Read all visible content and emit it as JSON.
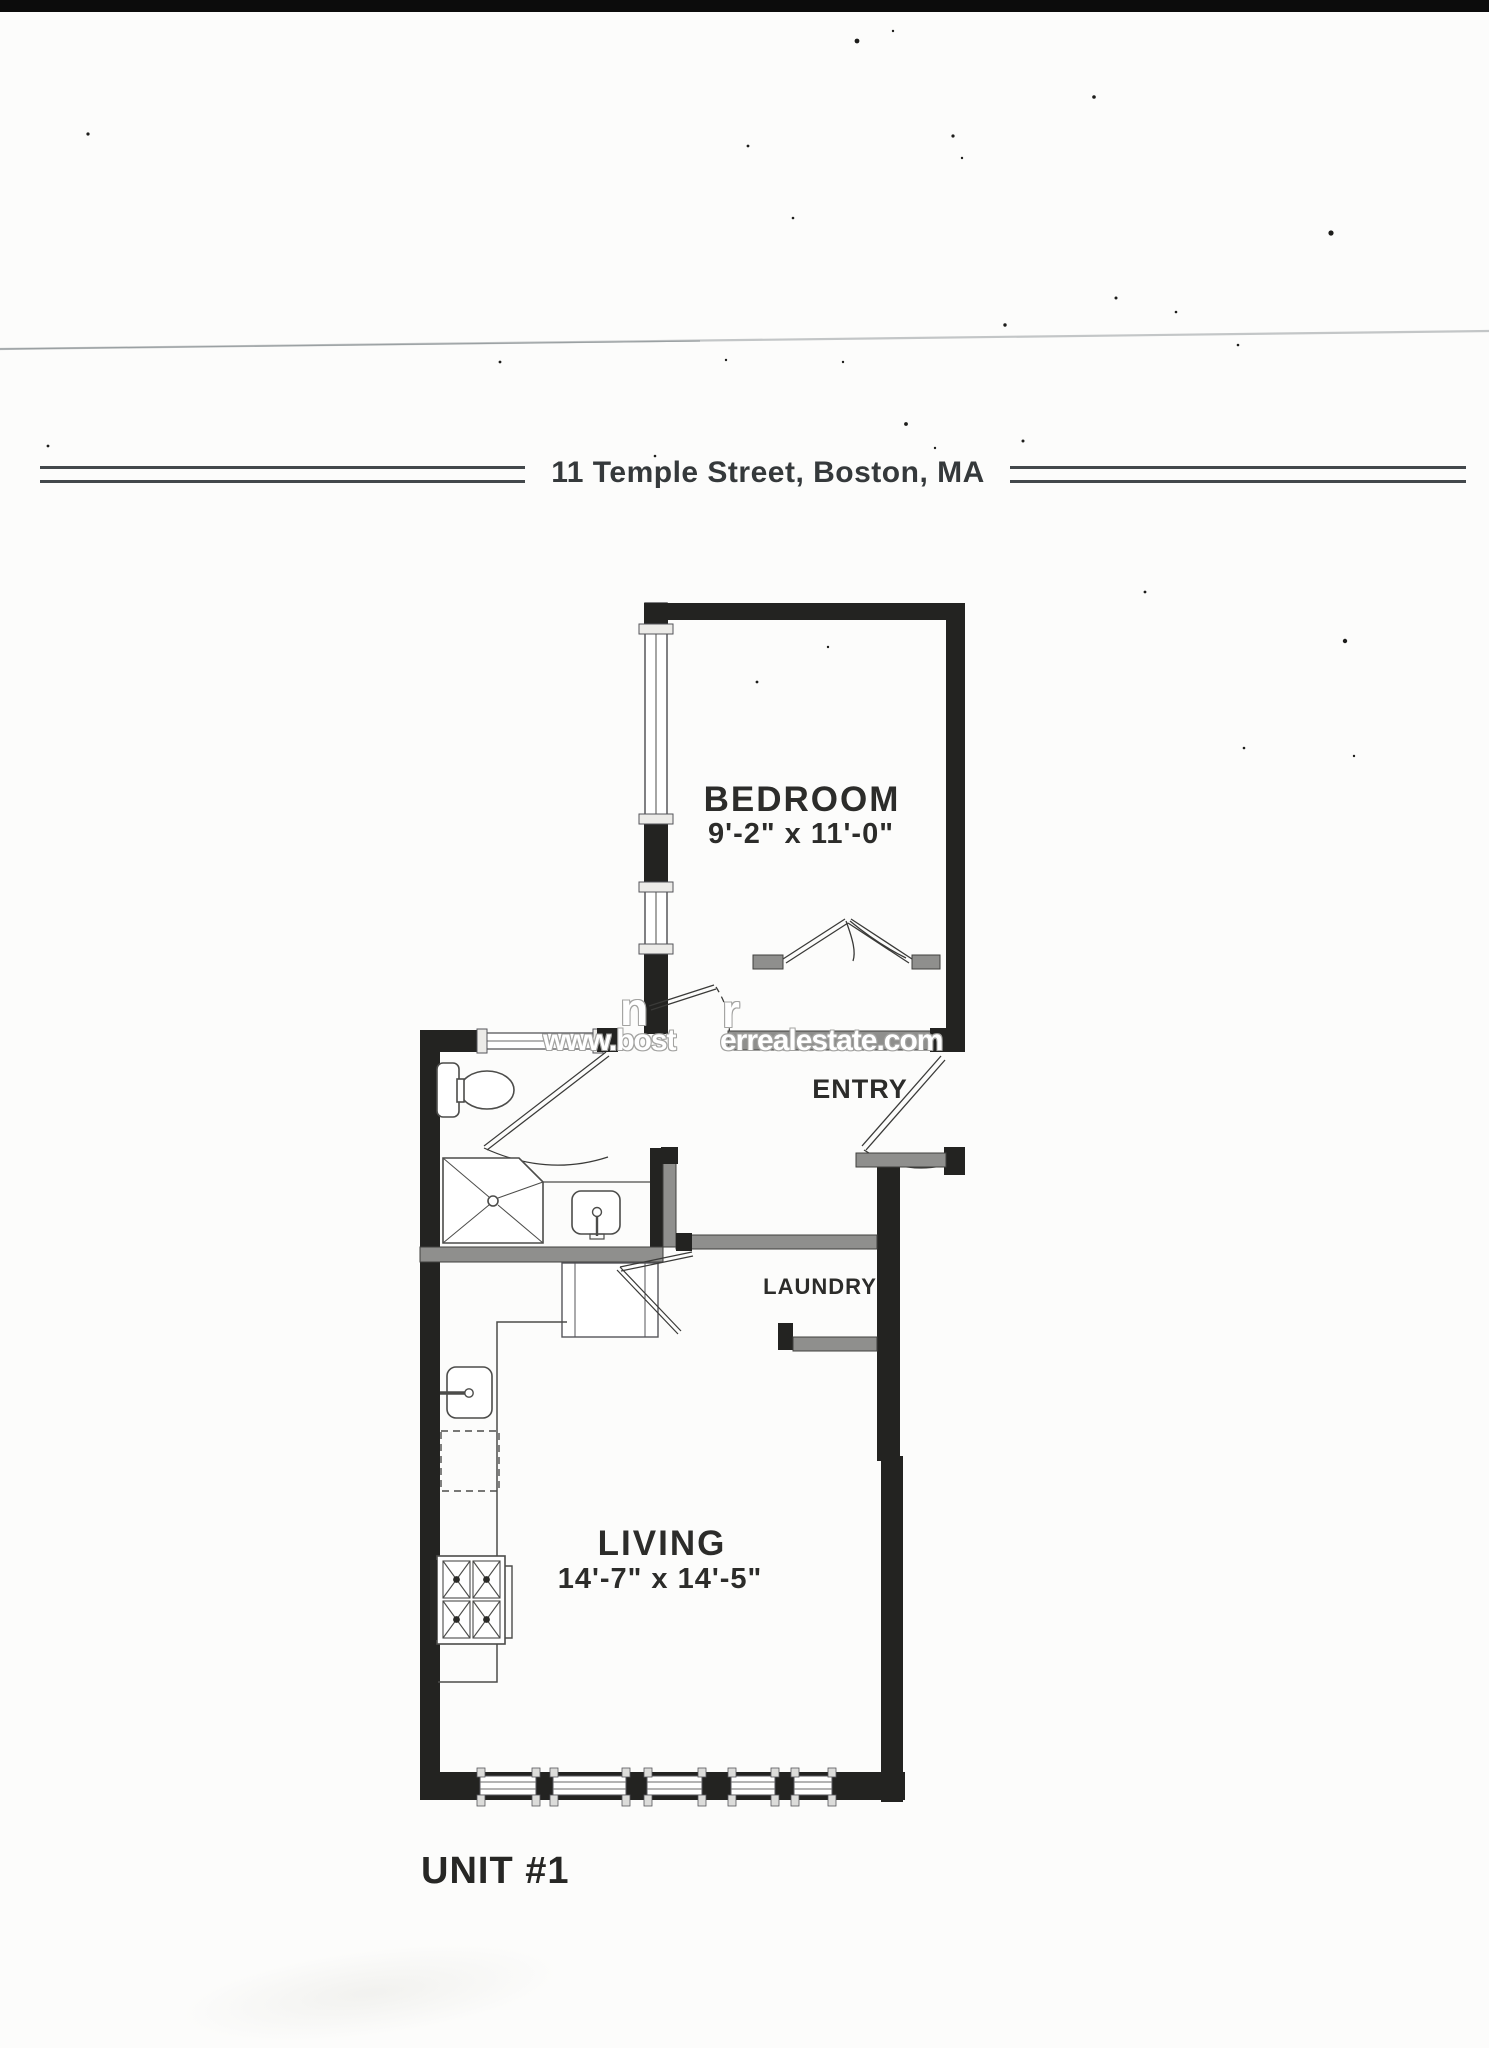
{
  "page": {
    "title": "11 Temple Street, Boston, MA",
    "unit_label": "UNIT #1"
  },
  "rooms": {
    "bedroom": {
      "name": "BEDROOM",
      "dimensions": "9'-2\" x 11'-0\""
    },
    "entry": {
      "name": "ENTRY"
    },
    "laundry": {
      "name": "LAUNDRY"
    },
    "living": {
      "name": "LIVING",
      "dimensions": "14'-7\" x 14'-5\""
    }
  },
  "watermark": {
    "line1_fragment_1": "n",
    "line1_fragment_2": "r",
    "url_fragment_left": "www.bost",
    "url_fragment_right": "errealestate.com"
  },
  "colors": {
    "wall_black": "#232321",
    "wall_gray": "#8f8f8d",
    "rule": "#43484b",
    "label_text": "#2c2c2a",
    "scan_bar": "#0c0c0c"
  }
}
